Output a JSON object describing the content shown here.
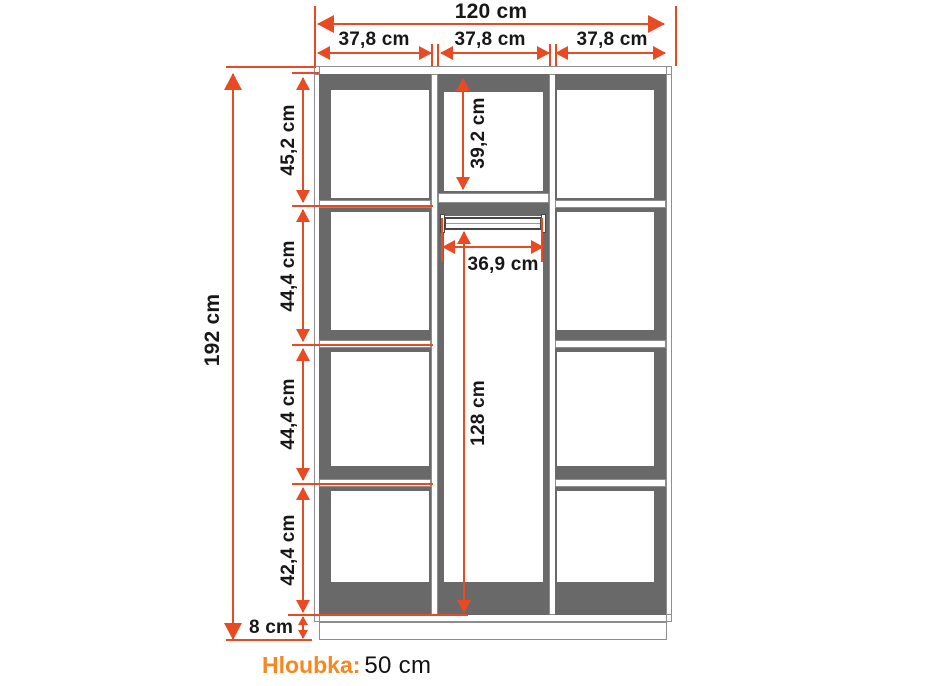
{
  "diagram": {
    "type": "wardrobe-dimension-diagram",
    "dimensions": {
      "total_width": "120 cm",
      "column_widths": [
        "37,8 cm",
        "37,8 cm",
        "37,8 cm"
      ],
      "total_height": "192 cm",
      "left_sections": [
        "45,2 cm",
        "44,4 cm",
        "44,4 cm",
        "42,4 cm"
      ],
      "middle_top_section": "39,2 cm",
      "rod_clearance_width": "36,9 cm",
      "middle_bottom_section": "128 cm",
      "plinth_height": "8 cm"
    },
    "footer": {
      "depth_label": "Hloubka:",
      "depth_value": "50 cm"
    },
    "colors": {
      "dimension_red": "#e84b24",
      "accent_orange": "#f6881f",
      "panel_gray": "#696969"
    }
  }
}
